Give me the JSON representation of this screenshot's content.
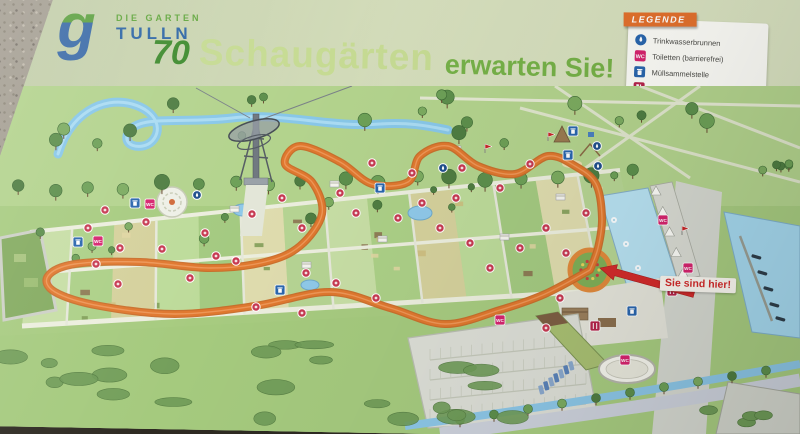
{
  "sign": {
    "logo": {
      "glyph": "g",
      "line1": "DIE GARTEN",
      "line2": "TULLN"
    },
    "title": {
      "number": "70",
      "highlight": "Schaugärten",
      "rest": "erwarten Sie!"
    },
    "legend": {
      "heading": "LEGENDE",
      "items": [
        {
          "name": "drinking-fountain",
          "label": "Trinkwasserbrunnen"
        },
        {
          "name": "toilets-accessible",
          "label": "Toiletten (barrierefrei)"
        },
        {
          "name": "waste-collection",
          "label": "Müllsammelstelle"
        },
        {
          "name": "food-and-drink",
          "label": "Essen & Trinken"
        }
      ]
    },
    "you_are_here": "Sie sind hier!"
  },
  "colors": {
    "header_green": "#63a73f",
    "header_blue": "#2f67a6",
    "legend_orange": "#e2702d",
    "orange_loop": "#e0782f",
    "marker_red": "#c73a52",
    "wc_pink": "#d6246e",
    "info_blue": "#2a66ad",
    "food_red": "#b5244a",
    "arrow_red": "#d22b2b",
    "river_blue": "#88c7e8"
  },
  "map": {
    "loop_path_points": [
      [
        590,
        184
      ],
      [
        545,
        208
      ],
      [
        500,
        224
      ],
      [
        445,
        238
      ],
      [
        390,
        222
      ],
      [
        330,
        206
      ],
      [
        255,
        220
      ],
      [
        175,
        228
      ],
      [
        100,
        220
      ],
      [
        55,
        206
      ],
      [
        48,
        190
      ],
      [
        75,
        178
      ],
      [
        140,
        176
      ],
      [
        210,
        182
      ],
      [
        265,
        176
      ],
      [
        300,
        160
      ],
      [
        322,
        128
      ],
      [
        312,
        96
      ],
      [
        285,
        78
      ],
      [
        300,
        60
      ],
      [
        340,
        76
      ],
      [
        372,
        98
      ],
      [
        408,
        96
      ],
      [
        420,
        70
      ],
      [
        448,
        60
      ],
      [
        478,
        80
      ],
      [
        515,
        88
      ],
      [
        548,
        70
      ],
      [
        575,
        80
      ],
      [
        596,
        98
      ],
      [
        602,
        132
      ],
      [
        598,
        162
      ],
      [
        590,
        184
      ]
    ],
    "markers": [
      {
        "t": "fountain",
        "x": 197,
        "y": 109
      },
      {
        "t": "fountain",
        "x": 597,
        "y": 60
      },
      {
        "t": "fountain",
        "x": 598,
        "y": 80
      },
      {
        "t": "fountain",
        "x": 443,
        "y": 82
      },
      {
        "t": "waste",
        "x": 78,
        "y": 156
      },
      {
        "t": "waste",
        "x": 280,
        "y": 204
      },
      {
        "t": "waste",
        "x": 380,
        "y": 102
      },
      {
        "t": "waste",
        "x": 632,
        "y": 225
      },
      {
        "t": "waste",
        "x": 568,
        "y": 69
      },
      {
        "t": "waste",
        "x": 135,
        "y": 117
      },
      {
        "t": "waste",
        "x": 573,
        "y": 45
      },
      {
        "t": "wc",
        "x": 98,
        "y": 155
      },
      {
        "t": "wc",
        "x": 150,
        "y": 118
      },
      {
        "t": "wc",
        "x": 500,
        "y": 234
      },
      {
        "t": "wc",
        "x": 625,
        "y": 274
      },
      {
        "t": "wc",
        "x": 663,
        "y": 134
      },
      {
        "t": "wc",
        "x": 688,
        "y": 182
      },
      {
        "t": "flag",
        "x": 485,
        "y": 67
      },
      {
        "t": "flag",
        "x": 682,
        "y": 149
      },
      {
        "t": "flag",
        "x": 548,
        "y": 55
      },
      {
        "t": "food",
        "x": 595,
        "y": 240
      },
      {
        "t": "food",
        "x": 672,
        "y": 205
      },
      {
        "t": "garden",
        "x": 105,
        "y": 124
      },
      {
        "t": "garden",
        "x": 88,
        "y": 142
      },
      {
        "t": "garden",
        "x": 120,
        "y": 162
      },
      {
        "t": "garden",
        "x": 146,
        "y": 136
      },
      {
        "t": "garden",
        "x": 162,
        "y": 163
      },
      {
        "t": "garden",
        "x": 190,
        "y": 192
      },
      {
        "t": "garden",
        "x": 216,
        "y": 170
      },
      {
        "t": "garden",
        "x": 236,
        "y": 175
      },
      {
        "t": "garden",
        "x": 118,
        "y": 198
      },
      {
        "t": "garden",
        "x": 96,
        "y": 178
      },
      {
        "t": "garden",
        "x": 282,
        "y": 112
      },
      {
        "t": "garden",
        "x": 302,
        "y": 142
      },
      {
        "t": "garden",
        "x": 340,
        "y": 107
      },
      {
        "t": "garden",
        "x": 356,
        "y": 127
      },
      {
        "t": "garden",
        "x": 306,
        "y": 187
      },
      {
        "t": "garden",
        "x": 336,
        "y": 197
      },
      {
        "t": "garden",
        "x": 376,
        "y": 212
      },
      {
        "t": "garden",
        "x": 302,
        "y": 227
      },
      {
        "t": "garden",
        "x": 256,
        "y": 221
      },
      {
        "t": "garden",
        "x": 422,
        "y": 117
      },
      {
        "t": "garden",
        "x": 440,
        "y": 142
      },
      {
        "t": "garden",
        "x": 456,
        "y": 112
      },
      {
        "t": "garden",
        "x": 470,
        "y": 157
      },
      {
        "t": "garden",
        "x": 490,
        "y": 182
      },
      {
        "t": "garden",
        "x": 520,
        "y": 162
      },
      {
        "t": "garden",
        "x": 546,
        "y": 142
      },
      {
        "t": "garden",
        "x": 566,
        "y": 167
      },
      {
        "t": "garden",
        "x": 586,
        "y": 127
      },
      {
        "t": "garden",
        "x": 500,
        "y": 102
      },
      {
        "t": "garden",
        "x": 530,
        "y": 78
      },
      {
        "t": "garden",
        "x": 462,
        "y": 82
      },
      {
        "t": "garden",
        "x": 412,
        "y": 87
      },
      {
        "t": "garden",
        "x": 372,
        "y": 77
      },
      {
        "t": "garden",
        "x": 560,
        "y": 212
      },
      {
        "t": "garden",
        "x": 546,
        "y": 242
      },
      {
        "t": "garden",
        "x": 205,
        "y": 147
      },
      {
        "t": "garden",
        "x": 252,
        "y": 128
      },
      {
        "t": "garden",
        "x": 398,
        "y": 132
      }
    ]
  }
}
